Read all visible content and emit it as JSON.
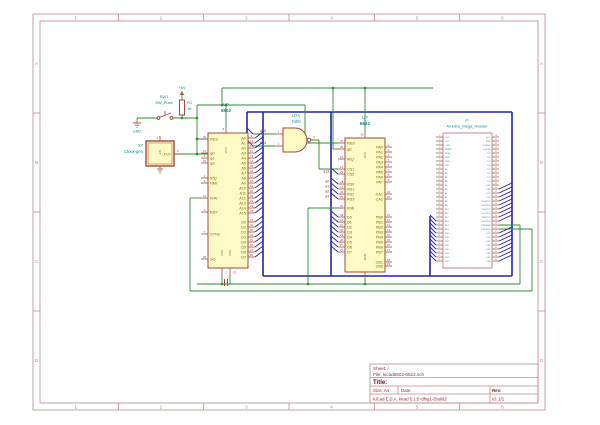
{
  "app": {
    "kind": "kicad-eeschema-schematic"
  },
  "colors": {
    "wire_green": "#2e8b2e",
    "bus_blue": "#2424a8",
    "symbol_outline": "#a04a3a",
    "symbol_fill": "#fdfac6",
    "pin_number_red": "#a05252",
    "pin_name_olive": "#6f6f00",
    "reference_teal": "#0b8c8c",
    "net_label_maroon": "#7a2828",
    "frame_red": "#c48484",
    "titleblock_text": "#8b2a2a",
    "header_outline": "#c07a7a"
  },
  "sheet": {
    "frame_columns": [
      "1",
      "2",
      "3",
      "4",
      "5",
      "6"
    ],
    "frame_rows": [
      "A",
      "B",
      "C",
      "D"
    ],
    "title_block": {
      "sheet_label": "Sheet: /",
      "file_label": "File: kicad6502-6522.sch",
      "title_label": "Title:",
      "size_label": "Size: A4",
      "date_label": "Date:",
      "rev_label": "Rev:",
      "kicad_label": "KiCad E.D.A.  kicad 5.1.5+dfsg1-2build2",
      "id_label": "Id: 1/1"
    }
  },
  "power": {
    "plus5v": "+5V",
    "gnd": "GND"
  },
  "net_labels": {
    "cs": "a13",
    "rs": [
      "a0",
      "a1",
      "a2",
      "a3"
    ],
    "nand_in": [
      "A15",
      "A14"
    ]
  },
  "components": {
    "resistor": {
      "ref": "R1",
      "value": "1K"
    },
    "switch": {
      "ref": "SW1",
      "value": "SW_Push"
    },
    "clock": {
      "ref": "X?",
      "value": "Clock-gen",
      "out_label": "OUT",
      "out_pin": "8",
      "en_pin": "1"
    },
    "nand": {
      "ref": "U?A",
      "value": "7400",
      "in_pins": [
        "1",
        "2"
      ],
      "out_pin": "3"
    },
    "cpu": {
      "ref": "U?",
      "value": "6502",
      "top_pins": [
        {
          "name": "VCC",
          "num": "8"
        }
      ],
      "bottom_pins": [
        {
          "name": "VSS",
          "num": "1"
        },
        {
          "name": "VSS",
          "num": "21"
        }
      ],
      "left_pins": [
        {
          "name": "RES",
          "num": "40",
          "bar": true
        },
        {
          "name": "φ0",
          "num": "37"
        },
        {
          "name": "φ1",
          "num": "3"
        },
        {
          "name": "φ2",
          "num": "39"
        },
        {
          "name": "IRQ",
          "num": "4",
          "bar": true
        },
        {
          "name": "NMI",
          "num": "6",
          "bar": true
        },
        {
          "name": "R/W",
          "num": "34"
        },
        {
          "name": "RDY",
          "num": "2"
        },
        {
          "name": "SYNC",
          "num": "7"
        },
        {
          "name": "SO",
          "num": "38",
          "bar": true
        }
      ],
      "right_pins": [
        {
          "name": "A0",
          "num": "9"
        },
        {
          "name": "A1",
          "num": "10"
        },
        {
          "name": "A2",
          "num": "11"
        },
        {
          "name": "A3",
          "num": "12"
        },
        {
          "name": "A4",
          "num": "13"
        },
        {
          "name": "A5",
          "num": "14"
        },
        {
          "name": "A6",
          "num": "15"
        },
        {
          "name": "A7",
          "num": "16"
        },
        {
          "name": "A8",
          "num": "17"
        },
        {
          "name": "A9",
          "num": "18"
        },
        {
          "name": "A10",
          "num": "19"
        },
        {
          "name": "A11",
          "num": "20"
        },
        {
          "name": "A12",
          "num": "22"
        },
        {
          "name": "A13",
          "num": "23"
        },
        {
          "name": "A14",
          "num": "24"
        },
        {
          "name": "A15",
          "num": "25"
        },
        {
          "name": "D0",
          "num": "33"
        },
        {
          "name": "D1",
          "num": "32"
        },
        {
          "name": "D2",
          "num": "31"
        },
        {
          "name": "D3",
          "num": "30"
        },
        {
          "name": "D4",
          "num": "29"
        },
        {
          "name": "D5",
          "num": "28"
        },
        {
          "name": "D6",
          "num": "27"
        },
        {
          "name": "D7",
          "num": "26"
        }
      ]
    },
    "via": {
      "ref": "U?",
      "value": "6522",
      "top_pins": [
        {
          "name": "VCC",
          "num": "20"
        }
      ],
      "bottom_pins": [
        {
          "name": "GND",
          "num": "1"
        }
      ],
      "left_pins": [
        {
          "name": "RES",
          "num": "34",
          "bar": true
        },
        {
          "name": "φ2",
          "num": "25"
        },
        {
          "name": "IRQ",
          "num": "21",
          "bar": true
        },
        {
          "name": "CS1",
          "num": "24"
        },
        {
          "name": "CS2",
          "num": "23",
          "bar": true
        },
        {
          "name": "RS0",
          "num": "38"
        },
        {
          "name": "RS1",
          "num": "37"
        },
        {
          "name": "RS2",
          "num": "36"
        },
        {
          "name": "RS3",
          "num": "35"
        },
        {
          "name": "R/W",
          "num": "22"
        },
        {
          "name": "D0",
          "num": "33"
        },
        {
          "name": "D1",
          "num": "32"
        },
        {
          "name": "D2",
          "num": "31"
        },
        {
          "name": "D3",
          "num": "30"
        },
        {
          "name": "D4",
          "num": "29"
        },
        {
          "name": "D5",
          "num": "28"
        },
        {
          "name": "D6",
          "num": "27"
        },
        {
          "name": "D7",
          "num": "26"
        }
      ],
      "right_pins": [
        {
          "name": "PA0",
          "num": "2"
        },
        {
          "name": "PA1",
          "num": "3"
        },
        {
          "name": "PA2",
          "num": "4"
        },
        {
          "name": "PA3",
          "num": "5"
        },
        {
          "name": "PA4",
          "num": "6"
        },
        {
          "name": "PA5",
          "num": "7"
        },
        {
          "name": "PA6",
          "num": "8"
        },
        {
          "name": "PA7",
          "num": "9"
        },
        {
          "name": "CA1",
          "num": "40"
        },
        {
          "name": "CA2",
          "num": "39"
        },
        {
          "name": "PB0",
          "num": "10"
        },
        {
          "name": "PB1",
          "num": "11"
        },
        {
          "name": "PB2",
          "num": "12"
        },
        {
          "name": "PB3",
          "num": "13"
        },
        {
          "name": "PB4",
          "num": "14"
        },
        {
          "name": "PB5",
          "num": "15"
        },
        {
          "name": "PB6",
          "num": "16"
        },
        {
          "name": "PB7",
          "num": "17"
        },
        {
          "name": "CB1",
          "num": "18"
        },
        {
          "name": "CB2",
          "num": "19"
        }
      ]
    },
    "header": {
      "ref": "J?",
      "value": "Arduino_Mega_Header",
      "left_pins": [
        {
          "name": "+5V",
          "num": "1"
        },
        {
          "name": "+5V",
          "num": "2"
        },
        {
          "name": "+3V3",
          "num": "3"
        },
        {
          "name": "RESET",
          "num": "4"
        },
        {
          "name": "AREF",
          "num": "5"
        },
        {
          "name": "GND",
          "num": "6"
        },
        {
          "name": "GND",
          "num": "7"
        },
        {
          "name": "VIN",
          "num": "8"
        },
        {
          "name": "A0",
          "num": "9"
        },
        {
          "name": "A1",
          "num": "10"
        },
        {
          "name": "A2",
          "num": "11"
        },
        {
          "name": "A3",
          "num": "12"
        },
        {
          "name": "A4",
          "num": "13"
        },
        {
          "name": "A5",
          "num": "14"
        },
        {
          "name": "A6",
          "num": "15"
        },
        {
          "name": "A7",
          "num": "16"
        },
        {
          "name": "A8",
          "num": "17"
        },
        {
          "name": "A9",
          "num": "18"
        },
        {
          "name": "A10",
          "num": "19"
        },
        {
          "name": "A11",
          "num": "20"
        },
        {
          "name": "A12",
          "num": "21"
        },
        {
          "name": "A13",
          "num": "22"
        },
        {
          "name": "A14",
          "num": "23"
        },
        {
          "name": "A15",
          "num": "24"
        },
        {
          "name": "D49",
          "num": "25"
        },
        {
          "name": "D48",
          "num": "26"
        },
        {
          "name": "D47",
          "num": "27"
        },
        {
          "name": "D46",
          "num": "28"
        },
        {
          "name": "D45",
          "num": "29"
        },
        {
          "name": "D44",
          "num": "30"
        },
        {
          "name": "D43",
          "num": "31"
        },
        {
          "name": "D42",
          "num": "32"
        }
      ],
      "right_pins": [
        {
          "name": "SCL",
          "num": "33"
        },
        {
          "name": "SDA",
          "num": "34"
        },
        {
          "name": "D0/RX0",
          "num": "35"
        },
        {
          "name": "D1/TX0",
          "num": "36"
        },
        {
          "name": "D2",
          "num": "37"
        },
        {
          "name": "D3",
          "num": "38"
        },
        {
          "name": "D4",
          "num": "39"
        },
        {
          "name": "D5",
          "num": "40"
        },
        {
          "name": "D6",
          "num": "41"
        },
        {
          "name": "D7",
          "num": "42"
        },
        {
          "name": "D8",
          "num": "43"
        },
        {
          "name": "D9",
          "num": "44"
        },
        {
          "name": "D10",
          "num": "45"
        },
        {
          "name": "D11",
          "num": "46"
        },
        {
          "name": "D12",
          "num": "47"
        },
        {
          "name": "D13",
          "num": "48"
        },
        {
          "name": "D14/TX3",
          "num": "49"
        },
        {
          "name": "D15/RX3",
          "num": "50"
        },
        {
          "name": "D16/TX2",
          "num": "51"
        },
        {
          "name": "D17/RX2",
          "num": "52"
        },
        {
          "name": "D18/TX1",
          "num": "53"
        },
        {
          "name": "D19/RX1",
          "num": "54"
        },
        {
          "name": "D20/SDA",
          "num": "55"
        },
        {
          "name": "D21/SCL",
          "num": "56"
        },
        {
          "name": "D22",
          "num": "57"
        },
        {
          "name": "D24",
          "num": "58"
        },
        {
          "name": "D26",
          "num": "59"
        },
        {
          "name": "D28",
          "num": "60"
        },
        {
          "name": "D30",
          "num": "61"
        },
        {
          "name": "D32",
          "num": "62"
        },
        {
          "name": "D34",
          "num": "63"
        },
        {
          "name": "D36",
          "num": "64"
        }
      ]
    }
  }
}
